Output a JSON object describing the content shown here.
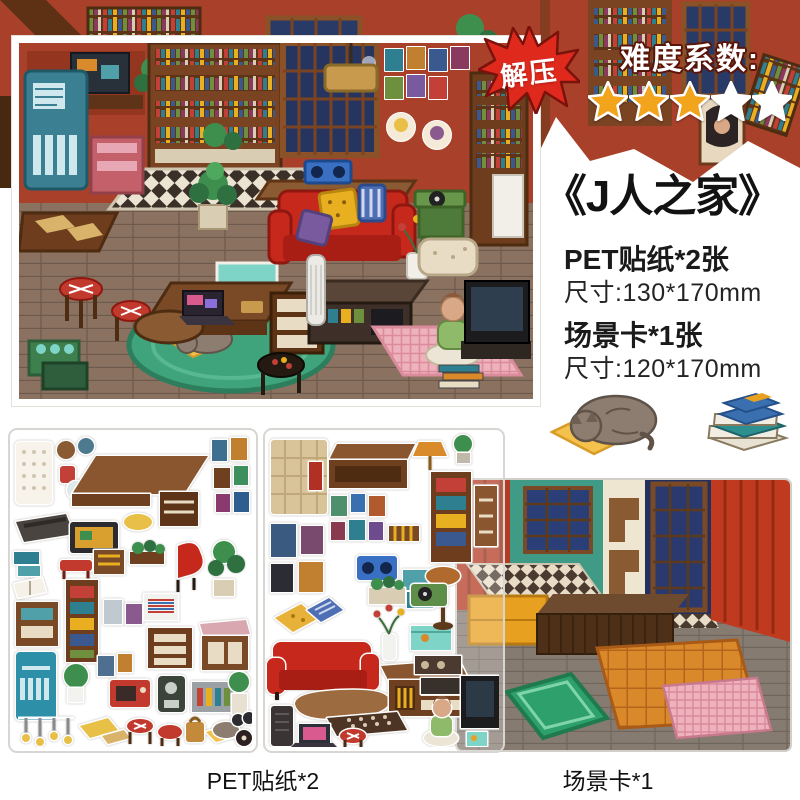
{
  "badge": {
    "label": "解压"
  },
  "difficulty": {
    "label": "难度系数:",
    "value": 3,
    "max": 5
  },
  "product": {
    "title": "《J人之家》",
    "specs": [
      {
        "name": "PET贴纸*2张",
        "size": "尺寸:130*170mm"
      },
      {
        "name": "场景卡*1张",
        "size": "尺寸:120*170mm"
      }
    ]
  },
  "footer": {
    "left_label": "PET贴纸*2",
    "right_label": "场景卡*1"
  },
  "illustrations": {
    "background": "pixel-art-library-room-strip",
    "main_scene": "isometric-pixel-living-room",
    "cat": "sleeping-cat-on-yellow-mat",
    "books": "stack-of-books",
    "sheet1": "furniture-sticker-sheet",
    "sheet2": "furniture-sticker-sheet-transparent",
    "scene_card": "empty-room-scene-card"
  },
  "palette": {
    "accent_red": "#e0291d",
    "star_gold": "#f2a41c",
    "star_white": "#ffffff",
    "wall_red": "#a8402a",
    "teal_wall": "#3f9b85",
    "sofa_red": "#c6281c",
    "rug_green": "#3fa47c",
    "card_border": "#d8d6d2"
  }
}
